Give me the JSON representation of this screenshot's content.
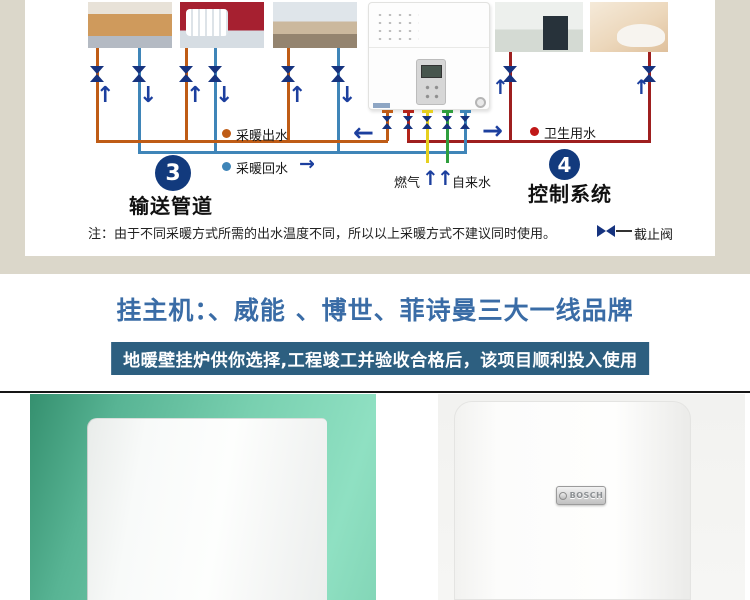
{
  "colors": {
    "page_beige": "#dbd7ca",
    "heating_supply_orange": "#bf5c16",
    "heating_return_blue": "#3f85b8",
    "sanitary_red": "#9e1f1f",
    "gas_yellow": "#e6d01f",
    "tap_water_green": "#2f9e3d",
    "valve_arrow_navy": "#16337f",
    "step_badge_navy": "#123a7d",
    "title_blue": "#3a6ca6",
    "banner_bg": "#2d5f80",
    "vaillant_photo_teal": "#79d0b0"
  },
  "symbols": {
    "up": "↑",
    "down": "↓",
    "left": "←",
    "right": "→"
  },
  "diagram": {
    "labels": {
      "heating_supply": "采暖出水",
      "heating_return": "采暖回水",
      "sanitary_water": "卫生用水",
      "gas": "燃气",
      "tap_water": "自来水"
    },
    "steps": {
      "three": {
        "number": "3",
        "label": "输送管道"
      },
      "four": {
        "number": "4",
        "label": "控制系统"
      }
    },
    "note": "注：由于不同采暖方式所需的出水温度不同，所以以上采暖方式不建议同时使用。",
    "stop_valve_label": "截止阀"
  },
  "brand_section": {
    "title": "挂主机：、威能 、博世、菲诗曼三大一线品牌",
    "banner": "地暖壁挂炉供你选择,工程竣工并验收合格后，该项目顺利投入使用"
  },
  "products": {
    "bosch_logo": "BOSCH"
  }
}
